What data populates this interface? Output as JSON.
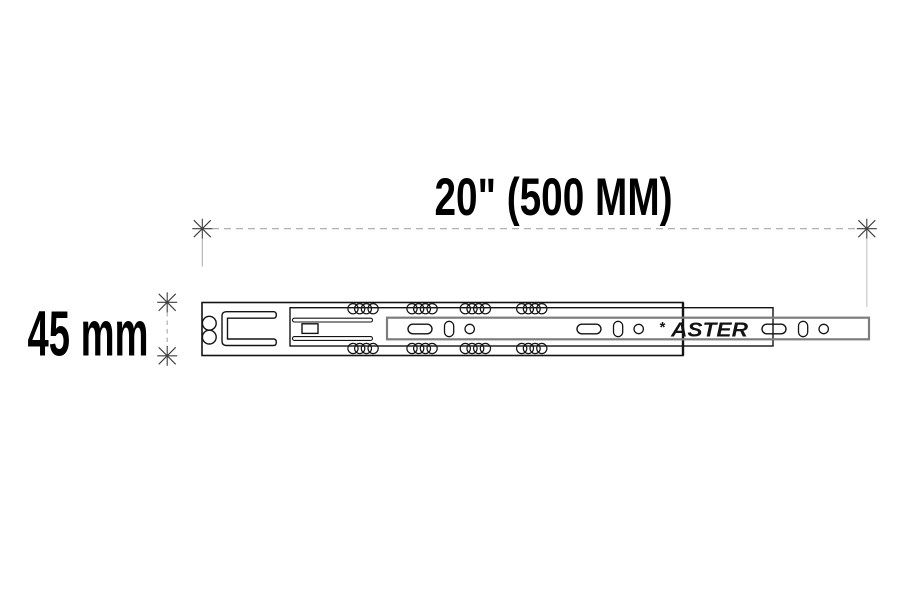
{
  "diagram": {
    "title": "Drawer slide technical drawing",
    "dimensions": {
      "width": {
        "label": "20\" (500 MM)"
      },
      "height": {
        "label": "45 mm"
      }
    },
    "brand": {
      "star": "*",
      "name": "ASTER"
    },
    "colors": {
      "background": "#ffffff",
      "ink": "#141414",
      "inner_rail_gray": "#7d7d7d",
      "dimension_line": "#a8a8a8",
      "dimension_extension_light": "#c8c8c8",
      "dimension_mark": "#3e3e3e",
      "label_text": "#000000"
    }
  }
}
